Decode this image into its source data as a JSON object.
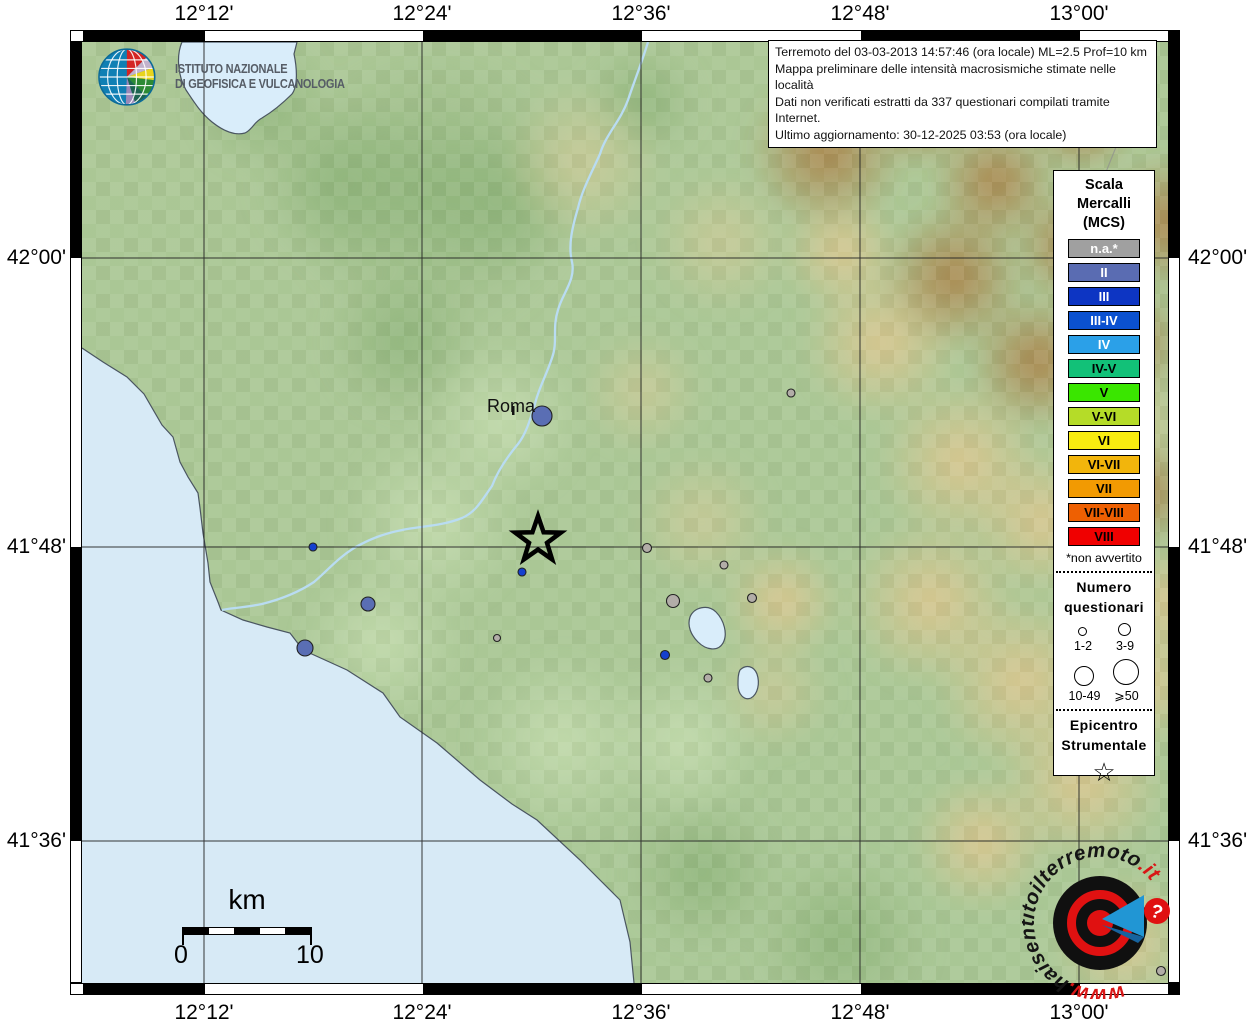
{
  "axes": {
    "top": [
      "12°12'",
      "12°24'",
      "12°36'",
      "12°48'",
      "13°00'"
    ],
    "bottom": [
      "12°12'",
      "12°24'",
      "12°36'",
      "12°48'",
      "13°00'"
    ],
    "left": [
      "42°00'",
      "41°48'",
      "41°36'"
    ],
    "right": [
      "42°00'",
      "41°48'",
      "41°36'"
    ]
  },
  "info_box": {
    "line1": "Terremoto del 03-03-2013 14:57:46 (ora locale) ML=2.5 Prof=10 km",
    "line2": "Mappa preliminare delle intensità macrosismiche stimate nelle località",
    "line3": "Dati non verificati estratti da 337 questionari compilati tramite Internet.",
    "line4": "Ultimo aggiornamento: 30-12-2025 03:53 (ora locale)"
  },
  "ingv_logo": {
    "line1": "ISTITUTO NAZIONALE",
    "line2": "DI GEOFISICA E VULCANOLOGIA"
  },
  "legend": {
    "title_line1": "Scala",
    "title_line2": "Mercalli",
    "title_line3": "(MCS)",
    "scale": [
      {
        "label": "n.a.*",
        "color": "#a0a0a0",
        "text_color": "#ffffff"
      },
      {
        "label": "II",
        "color": "#5a6cb2",
        "text_color": "#ffffff"
      },
      {
        "label": "III",
        "color": "#0d35c3",
        "text_color": "#ffffff"
      },
      {
        "label": "III-IV",
        "color": "#0b51d0",
        "text_color": "#ffffff"
      },
      {
        "label": "IV",
        "color": "#2ba0e8",
        "text_color": "#ffffff"
      },
      {
        "label": "IV-V",
        "color": "#12c178",
        "text_color": "#000000"
      },
      {
        "label": "V",
        "color": "#3ae600",
        "text_color": "#000000"
      },
      {
        "label": "V-VI",
        "color": "#b5dc28",
        "text_color": "#000000"
      },
      {
        "label": "VI",
        "color": "#f8ec10",
        "text_color": "#000000"
      },
      {
        "label": "VI-VII",
        "color": "#f2b50c",
        "text_color": "#000000"
      },
      {
        "label": "VII",
        "color": "#f29a02",
        "text_color": "#000000"
      },
      {
        "label": "VII-VIII",
        "color": "#ee6002",
        "text_color": "#000000"
      },
      {
        "label": "VIII",
        "color": "#f00000",
        "text_color": "#000000"
      }
    ],
    "footnote": "*non avvertito",
    "questionnaires": {
      "title_line1": "Numero",
      "title_line2": "questionari",
      "sizes": [
        "1-2",
        "3-9",
        "10-49",
        "⩾50"
      ]
    },
    "epicenter": {
      "title_line1": "Epicentro",
      "title_line2": "Strumentale"
    }
  },
  "map": {
    "city_label": "Roma",
    "scalebar": {
      "unit": "km",
      "start": "0",
      "end": "10"
    },
    "marker_colors": {
      "na": "#b2ada8",
      "II": "#5a6eb4",
      "III": "#1540cf"
    },
    "markers": [
      {
        "x": 460,
        "y": 374,
        "r": 10,
        "level": "II"
      },
      {
        "x": 231,
        "y": 505,
        "r": 4,
        "level": "III"
      },
      {
        "x": 440,
        "y": 530,
        "r": 4,
        "level": "III"
      },
      {
        "x": 286,
        "y": 562,
        "r": 7,
        "level": "II"
      },
      {
        "x": 223,
        "y": 606,
        "r": 8,
        "level": "II"
      },
      {
        "x": 415,
        "y": 596,
        "r": 3.5,
        "level": "na"
      },
      {
        "x": 709,
        "y": 351,
        "r": 4,
        "level": "na"
      },
      {
        "x": 565,
        "y": 506,
        "r": 4.5,
        "level": "na"
      },
      {
        "x": 642,
        "y": 523,
        "r": 4,
        "level": "na"
      },
      {
        "x": 591,
        "y": 559,
        "r": 6.5,
        "level": "na"
      },
      {
        "x": 670,
        "y": 556,
        "r": 4.5,
        "level": "na"
      },
      {
        "x": 583,
        "y": 613,
        "r": 4.5,
        "level": "III"
      },
      {
        "x": 626,
        "y": 636,
        "r": 4,
        "level": "na"
      },
      {
        "x": 1079,
        "y": 929,
        "r": 4.5,
        "level": "na"
      }
    ],
    "epicenter_star": {
      "x": 456,
      "y": 498
    }
  },
  "footer_logo": {
    "prefix": "www.",
    "main": "haisentitoilterremoto",
    "suffix": ".it",
    "badge": "?"
  }
}
